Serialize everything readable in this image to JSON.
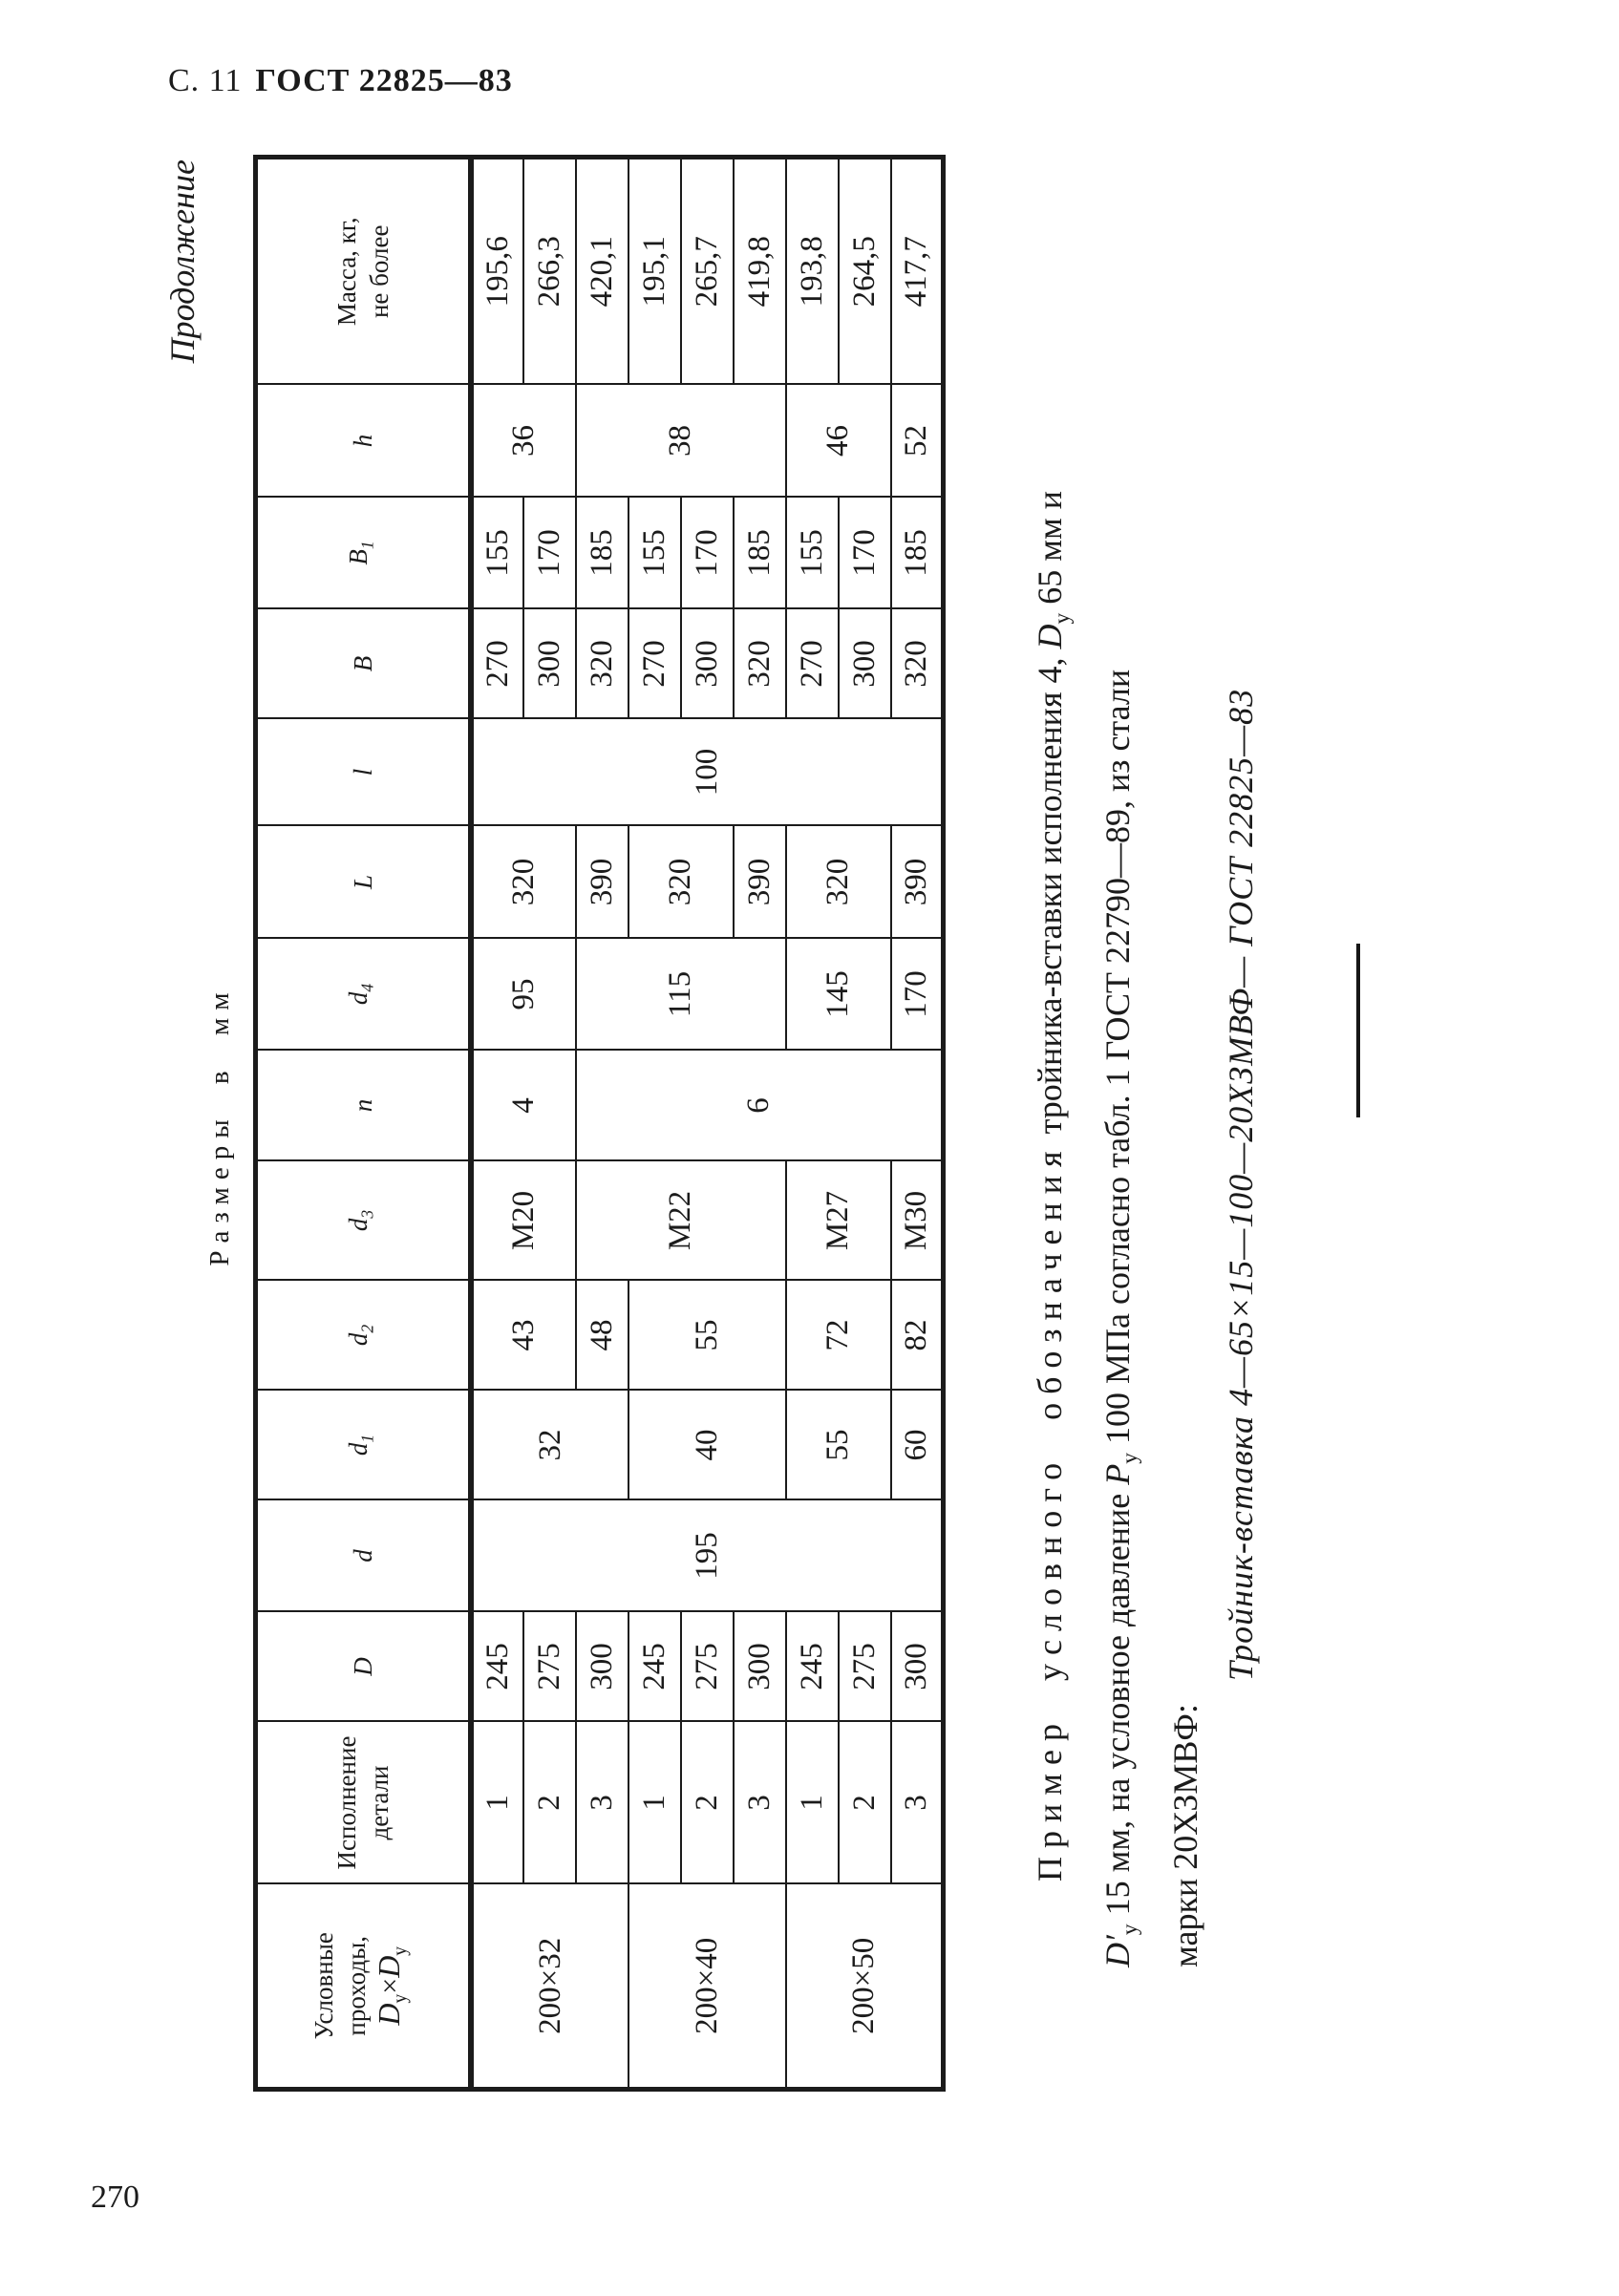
{
  "page": {
    "header_prefix": "С. 11",
    "header_gost": "ГОСТ 22825—83",
    "page_number": "270"
  },
  "labels": {
    "continuation": "Продолжение",
    "dimensions": "Размеры в мм"
  },
  "table": {
    "headers": {
      "usl": {
        "line1": "Условные",
        "line2": "проходы,",
        "f_d1": "D",
        "f_s1": "у",
        "f_x": "×",
        "f_d2": "D",
        "f_s2": "у"
      },
      "isp": {
        "line1": "Исполнение",
        "line2": "детали"
      },
      "D": "D",
      "d": "d",
      "d1": {
        "base": "d",
        "sub": "1"
      },
      "d2": {
        "base": "d",
        "sub": "2"
      },
      "d3": {
        "base": "d",
        "sub": "3"
      },
      "n": "n",
      "d4": {
        "base": "d",
        "sub": "4"
      },
      "L": "L",
      "l": "l",
      "B": "B",
      "B1": {
        "base": "B",
        "sub": "1"
      },
      "h": "h",
      "massa": {
        "line1": "Масса, кг,",
        "line2": "не более"
      }
    },
    "rows": [
      {
        "cells": [
          "200×32",
          "1",
          "245",
          "195",
          "32",
          "43",
          "М20",
          "4",
          "95",
          "320",
          "100",
          "270",
          "155",
          "36",
          "195,6"
        ]
      },
      {
        "cells": [
          "2",
          "275",
          "300",
          "170",
          "266,3"
        ]
      },
      {
        "cells": [
          "3",
          "300",
          "48",
          "М22",
          "6",
          "115",
          "390",
          "320",
          "185",
          "38",
          "420,1"
        ]
      },
      {
        "cells": [
          "200×40",
          "1",
          "245",
          "40",
          "55",
          "320",
          "270",
          "155",
          "195,1"
        ]
      },
      {
        "cells": [
          "2",
          "275",
          "300",
          "170",
          "265,7"
        ]
      },
      {
        "cells": [
          "3",
          "300",
          "390",
          "320",
          "185",
          "419,8"
        ]
      },
      {
        "cells": [
          "200×50",
          "1",
          "245",
          "55",
          "72",
          "М27",
          "145",
          "320",
          "270",
          "155",
          "46",
          "193,8"
        ]
      },
      {
        "cells": [
          "2",
          "275",
          "300",
          "170",
          "264,5"
        ]
      },
      {
        "cells": [
          "3",
          "300",
          "60",
          "82",
          "М30",
          "170",
          "390",
          "320",
          "185",
          "52",
          "417,7"
        ]
      }
    ]
  },
  "example": {
    "l1_spaced": "Пример условного обозначения",
    "l1_mid": " тройника-вставки исполнения 4, ",
    "l1_d": "D",
    "l1_sub": "у",
    "l1_end": " 65 мм и",
    "l2_d": "D′",
    "l2_sub": "у",
    "l2_mid": " 15 мм, на условное давление ",
    "l2_p": "Р",
    "l2_psub": "у",
    "l2_end": " 100 МПа согласно табл. 1 ГОСТ 22790—89, из стали",
    "l3": "марки 20ХЗМВФ:",
    "l4": "Тройник-вставка 4—65×15—100—20ХЗМВФ— ГОСТ 22825—83"
  }
}
